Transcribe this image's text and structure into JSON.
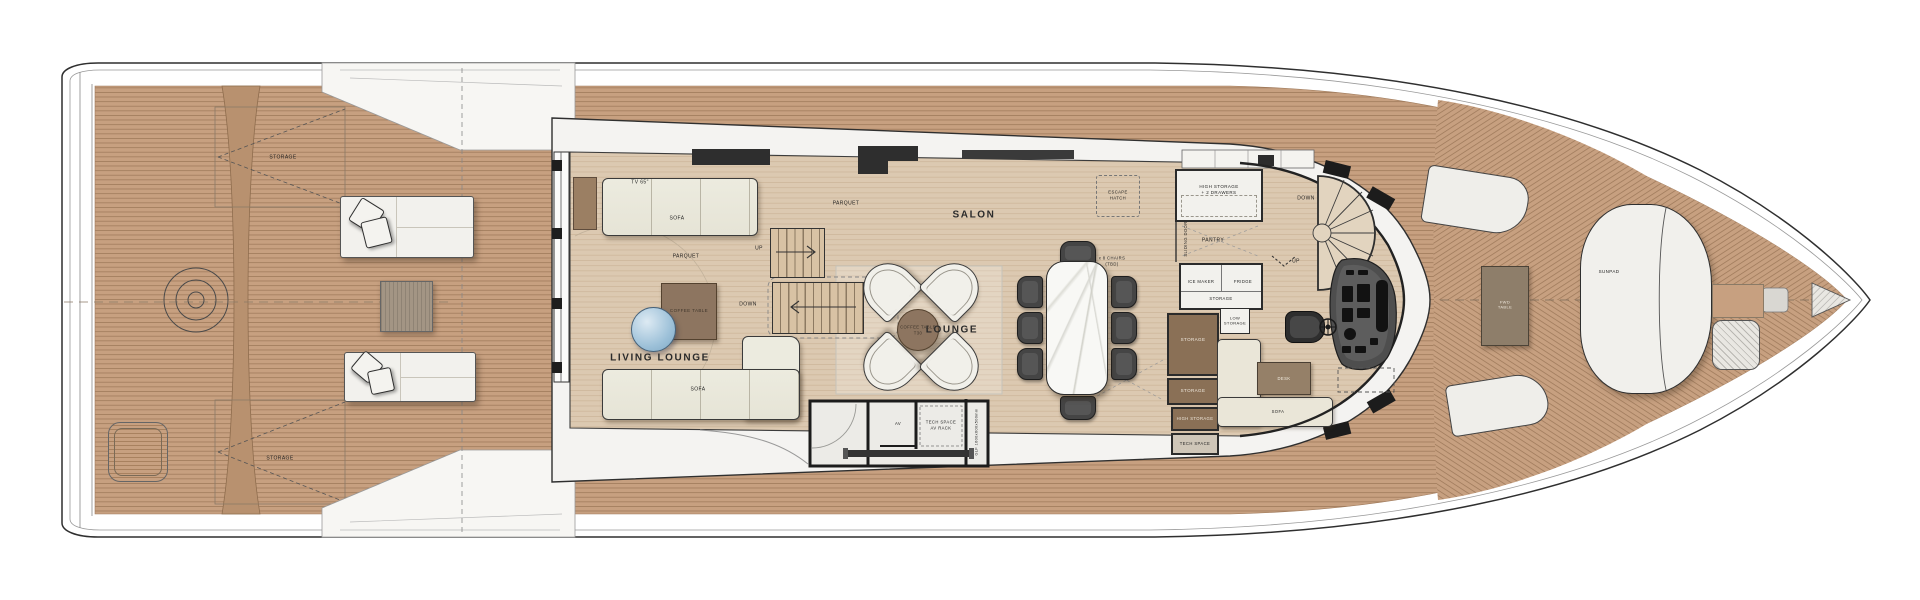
{
  "regions": {
    "living_lounge": "LIVING LOUNGE",
    "lounge": "LOUNGE",
    "salon": "SALON"
  },
  "labels": {
    "storage_aft_top": "STORAGE",
    "storage_aft_bottom": "STORAGE",
    "tv": "TV 65\"",
    "sofa_main": "SOFA",
    "sofa_aft": "SOFA",
    "sofa_helm": "SOFA",
    "parquet_aft": "PARQUET",
    "parquet_fwd": "PARQUET",
    "coffee_table": "COFFEE TABLE",
    "coffee_table_round_1": "COFFEE TABLE",
    "coffee_table_round_2": "T30",
    "up_mid": "UP",
    "down_mid": "DOWN",
    "up_fwd": "UP",
    "down_fwd": "DOWN",
    "chairs_note_1": "x 8 CHAIRS",
    "chairs_note_2": "(TBD)",
    "escape_hatch_1": "ESCAPE",
    "escape_hatch_2": "HATCH",
    "high_storage_1": "HIGH STORAGE",
    "high_storage_2": "+ 2 DRAWERS",
    "pantry": "PANTRY",
    "sliding_door": "SLIDING DOOR",
    "ice_maker": "ICE MAKER",
    "fridge": "FRIDGE",
    "storage_pantry": "STORAGE",
    "low_storage_1": "LOW",
    "low_storage_2": "STORAGE",
    "storage_col_1": "STORAGE",
    "storage_col_2": "STORAGE",
    "high_storage_col": "HIGH STORAGE",
    "tech_space_col": "TECH SPACE",
    "desk": "DESK",
    "av": "AV",
    "tech_space_1": "TECH SPACE",
    "tech_space_2": "AV RACK",
    "locker_dim": "GLF 1600x600x500mm",
    "fwd_table_1": "FWD",
    "fwd_table_2": "TABLE",
    "sunpad": "SUNPAD"
  },
  "colors": {
    "teak": "#c7a080",
    "teak_line": "#a07b5c",
    "teak_dark_band": "#b8916f",
    "parquet": "#dcc9b1",
    "parquet_line": "#c9b194",
    "hull_line": "#2f2f2f",
    "furniture_brown": "#8d7560",
    "cabinet_brown": "#8a7056",
    "sofa_cream": "#ecebdf",
    "chair_dark": "#454545",
    "round_table_blue": "#9cc0d8",
    "marble": "#f8f8f5"
  }
}
